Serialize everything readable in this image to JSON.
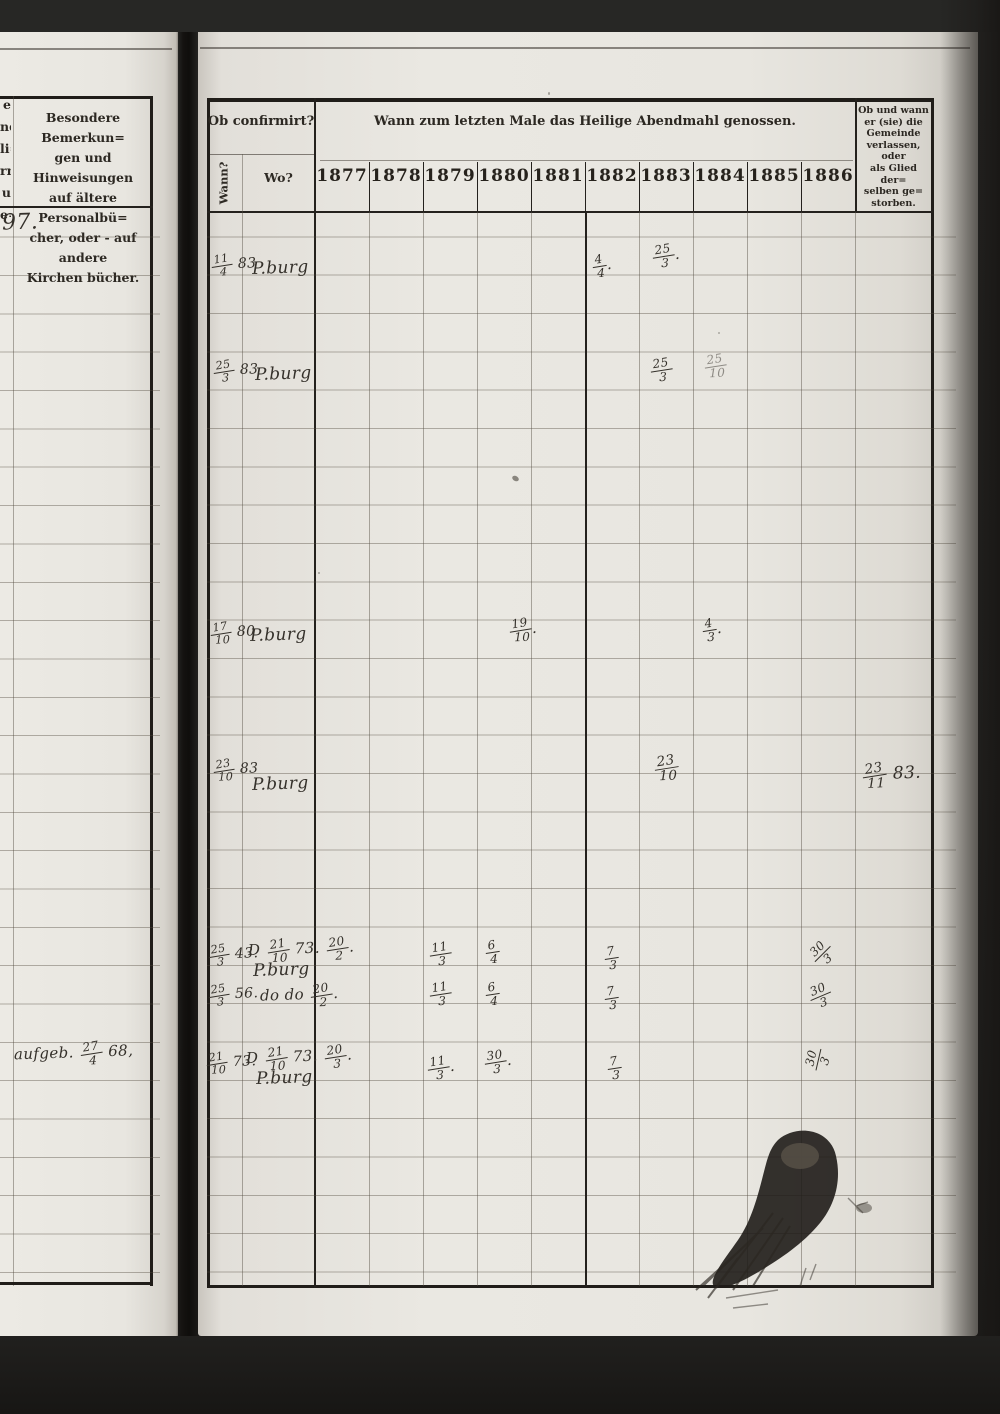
{
  "left_page": {
    "margin_fragments": [
      "e",
      "nd",
      "li=",
      "rn",
      "u",
      "e="
    ],
    "remarks_header_lines": [
      "Besondere Bemerkun=",
      "gen und Hinweisungen",
      "auf ältere Personalbü=",
      "cher, oder - auf andere",
      "Kirchen bücher."
    ],
    "handwritten_number": "97.",
    "handwritten_note": "aufgeb. 27/4 68,"
  },
  "right_page": {
    "confirmation_header": "Ob confirmirt?",
    "wann_label": "Wann?",
    "wo_label": "Wo?",
    "communion_header": "Wann zum letzten Male das Heilige Abendmahl genossen.",
    "years": [
      "1877",
      "1878",
      "1879",
      "1880",
      "1881",
      "1882",
      "1883",
      "1884",
      "1885",
      "1886"
    ],
    "departure_header_lines": [
      "Ob und wann",
      "er (sie) die",
      "Gemeinde",
      "verlassen, oder",
      "als Glied der=",
      "selben ge=",
      "storben."
    ],
    "entries": {
      "row1": {
        "wann": "11/4 83",
        "wo": "P.burg",
        "y1882": "4/4.",
        "y1883": "25/3."
      },
      "row2": {
        "wann": "25/3 83",
        "wo": "P.burg",
        "y1883": "25/3",
        "y1884": "25/10"
      },
      "row3": {
        "wann": "17/10 80",
        "wo": "P.burg",
        "y1880": "19/10.",
        "y1884": "4/3."
      },
      "row4": {
        "wann": "23/10 83",
        "wo": "P.burg",
        "y1883": "23/10",
        "departure": "23/11 83."
      },
      "row5": {
        "wann": "25/3 43.",
        "wo_note": "D 21/10 73. 20/2.",
        "wo": "P.burg",
        "y1879": "11/3",
        "y1880": "6/4",
        "y1882": "7/3",
        "y1885": "30/3"
      },
      "row6": {
        "wann": "25/3 56.",
        "wo": "do  do  20/2.",
        "y1879": "11/3",
        "y1880": "6/4",
        "y1882": "7/3",
        "y1885": "30/3"
      },
      "row7": {
        "wann": "21/10 73.",
        "wo_note": "D 21/10 73. 20/3.",
        "wo": "P.burg",
        "y1879": "11/3.",
        "y1880": "30/3.",
        "y1882": "7/3",
        "y1885": "30/3"
      }
    }
  }
}
